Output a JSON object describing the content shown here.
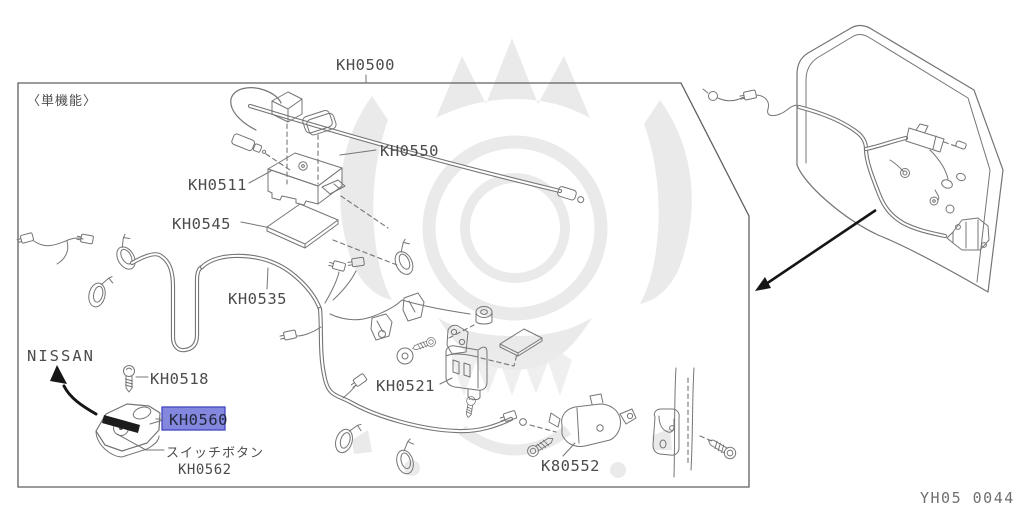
{
  "diagram": {
    "drawing_code": "YH05 0044",
    "note": "〈単機能〉",
    "brand": "NISSAN",
    "highlighted_part": "KH0560",
    "parts": {
      "assembly": "KH0500",
      "antenna_rod": "KH0550",
      "control_unit": "KH0511",
      "pad": "KH0545",
      "harness": "KH0535",
      "screw": "KH0518",
      "remote_keyfob": "KH0560",
      "switch_button_part": "KH0562",
      "actuator": "KH0521",
      "lock_actuator": "K80552"
    },
    "annotations": {
      "switch_button": "スイッチボタン"
    },
    "colors": {
      "line_art": "#757575",
      "label_text": "#4c4c4c",
      "code_text": "#6f6f6f",
      "highlight_fill": "#8388de",
      "highlight_border": "#4045c2",
      "arrow_black": "#161616",
      "watermark": "#e8e8e8",
      "background": "#ffffff"
    }
  }
}
